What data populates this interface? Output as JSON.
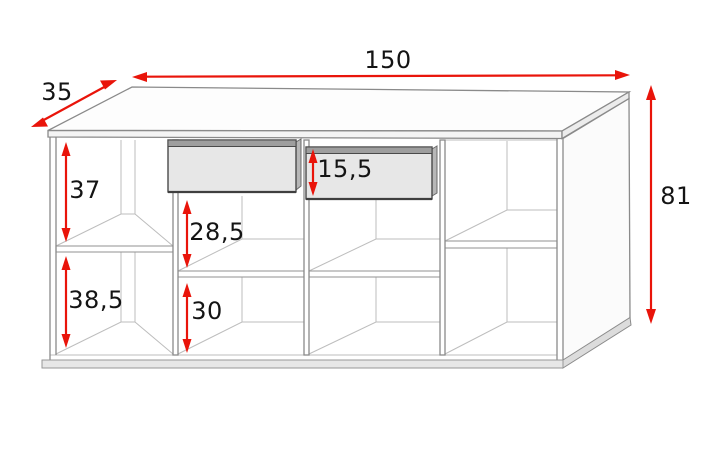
{
  "diagram": {
    "kind": "furniture-dimension-diagram",
    "subject": "sideboard with two drawers and open shelf compartments",
    "units_implied": "cm",
    "colors": {
      "background": "#ffffff",
      "dimension_arrow": "#e9140a",
      "label_text": "#141414",
      "carcass_outline": "#8a8a8a",
      "interior_line": "#bdbdbd",
      "drawer_body": "#e7e7e7",
      "drawer_top": "#9e9e9e",
      "drawer_outline": "#4a4a4a",
      "base_fill": "#e7e7e7"
    },
    "dims": {
      "width": {
        "text": "150",
        "meaning": "overall width (top, horizontal arrow)"
      },
      "depth": {
        "text": "35",
        "meaning": "overall depth (top-left diagonal arrow)"
      },
      "height": {
        "text": "81",
        "meaning": "overall height (right vertical arrow)"
      },
      "upper_left": {
        "text": "37",
        "meaning": "left compartment upper section height"
      },
      "lower_left": {
        "text": "38,5",
        "meaning": "left compartment lower section height"
      },
      "middle_upper": {
        "text": "28,5",
        "meaning": "middle compartment height under drawer"
      },
      "middle_lower": {
        "text": "30",
        "meaning": "middle compartment lower section height"
      },
      "drawer_front": {
        "text": "15,5",
        "meaning": "drawer front height"
      }
    }
  }
}
